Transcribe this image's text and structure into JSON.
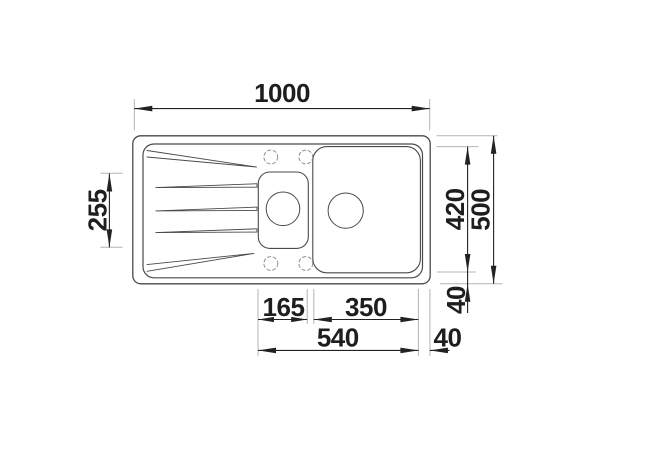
{
  "drawing": {
    "kind": "sink-top-view-dimension-drawing",
    "colors": {
      "background": "#ffffff",
      "outline": "#4a4a4a",
      "dimension_line": "#222222",
      "extension_line": "#b4b4b4",
      "tap_hole_dashed": "#8f8f8f"
    }
  },
  "dims": {
    "overall_width": "1000",
    "drainboard_section_depth": "255",
    "inner_depth": "420",
    "overall_depth": "500",
    "rim_offset_right": "40",
    "half_bowl_width": "165",
    "main_bowl_width": "350",
    "bowls_span": "540",
    "rim_offset_bottom": "40"
  }
}
